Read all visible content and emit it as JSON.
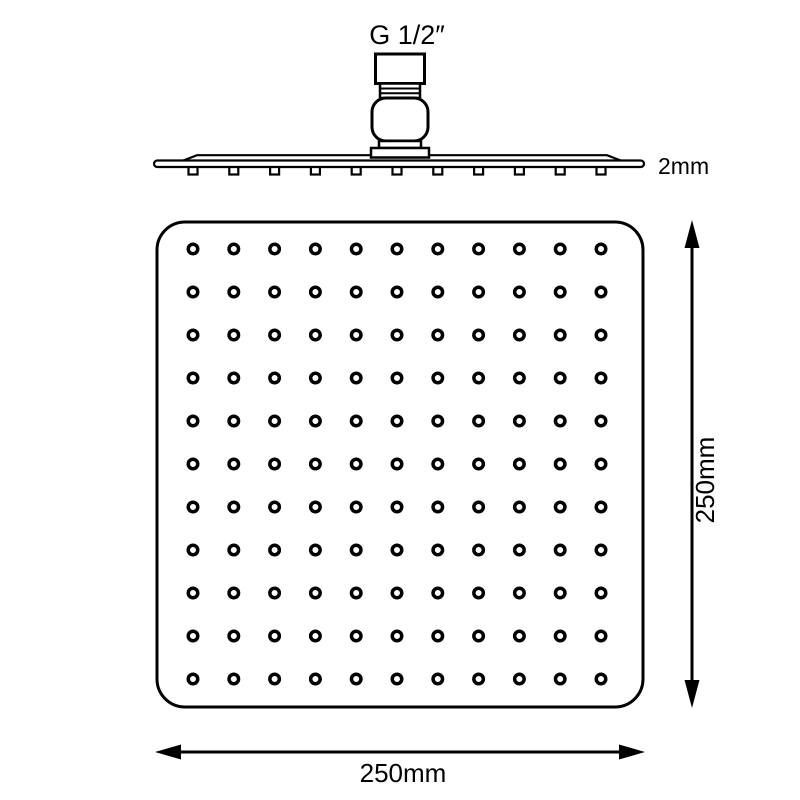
{
  "diagram": {
    "title": "square-rain-shower-head-technical-drawing",
    "labels": {
      "thread_size": "G 1/2″",
      "plate_thickness": "2mm",
      "height_dimension": "250mm",
      "width_dimension": "250mm"
    },
    "colors": {
      "line": "#000000",
      "background": "#ffffff"
    },
    "hole_grid": {
      "rows": 11,
      "cols": 11,
      "x_start": 193,
      "y_start": 249,
      "x_step": 40.8,
      "y_step": 43,
      "hole_radius": 4.75
    },
    "side_nozzles": {
      "count": 11,
      "x_start": 193,
      "x_step": 40.8,
      "y": 166,
      "width": 9,
      "height": 8.5
    }
  }
}
